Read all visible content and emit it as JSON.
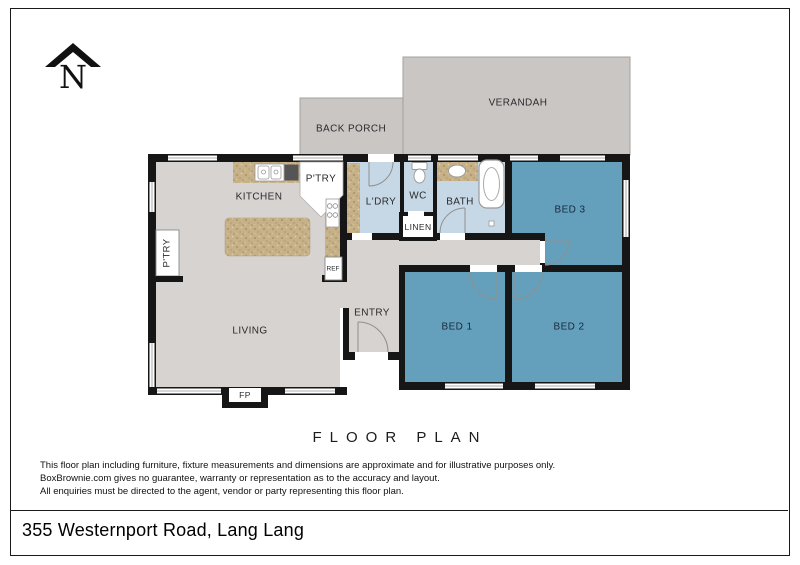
{
  "page": {
    "floor_plan_title": "FLOOR PLAN",
    "address": "355 Westernport Road, Lang Lang",
    "compass_letter": "N"
  },
  "rooms": {
    "verandah": "VERANDAH",
    "back_porch": "BACK PORCH",
    "kitchen": "KITCHEN",
    "corner_pantry": "P'TRY",
    "left_pantry": "P'TRY",
    "laundry": "L'DRY",
    "wc": "WC",
    "bath": "BATH",
    "linen": "LINEN",
    "bed1": "BED 1",
    "bed2": "BED 2",
    "bed3": "BED 3",
    "living": "LIVING",
    "entry": "ENTRY",
    "fridge": "REF",
    "fireplace": "FP"
  },
  "disclaimer": {
    "line1": "This floor plan including furniture, fixture measurements and dimensions are approximate and for illustrative purposes only.",
    "line2": "BoxBrownie.com gives no guarantee, warranty or representation as to the accuracy and layout.",
    "line3": "All enquiries must be directed to the agent, vendor or party representing this floor plan."
  },
  "colors": {
    "bedroom_fill": "#64a0bb",
    "wet_area_fill": "#c6d8e5",
    "floor_fill": "#d7d3d0",
    "outdoor_fill": "#cac6c3",
    "counter_fill": "#c6b189",
    "wall": "#161616"
  }
}
